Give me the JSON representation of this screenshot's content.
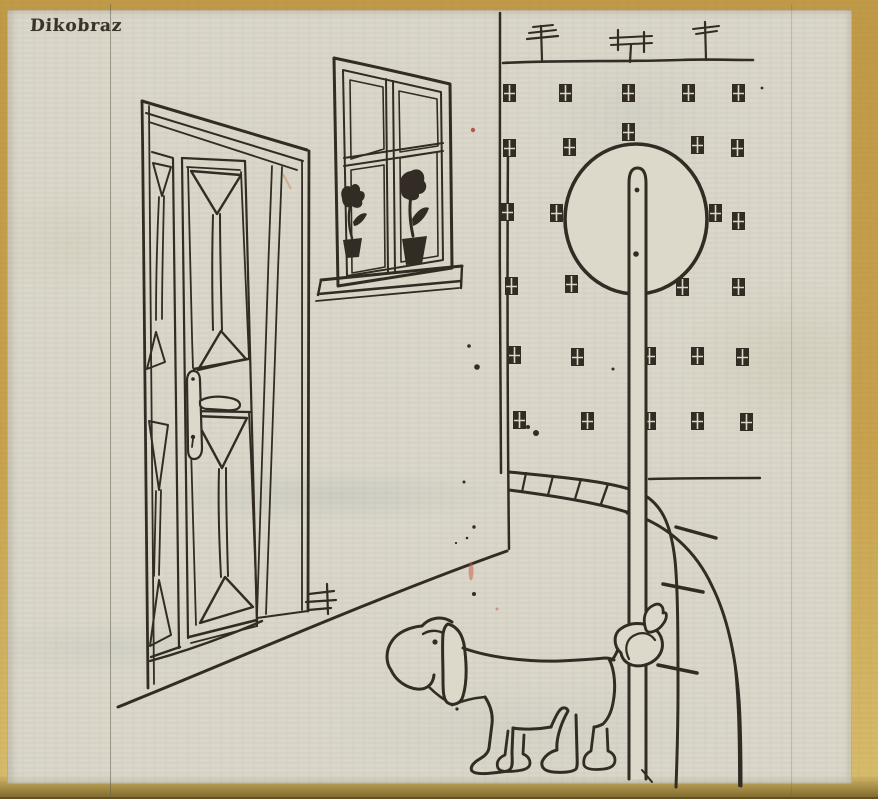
{
  "masthead": {
    "label": "Dikobraz"
  },
  "scene": {
    "description": "Hand-drawn ink cartoon: a long-eared dog stands in a street with its tail tied in a knot around a tall sign pole topped by a large circle. To the left, a house with an open paneled double door (lever handle and keyhole plate) and a four-pane window holding two potted flowers on the sill. Behind, a building facade with a roofline carrying three TV antennas and rows of tiny four-pane windows, a low stone parapet that curves down as an arch of blocks, and scattered ink specks on aged, yellow-bordered newsprint with bleed-through text."
  },
  "objects": [
    "paneled-double-door",
    "door-lever-handle",
    "keyhole-plate",
    "four-pane-window",
    "potted-flower-left",
    "potted-flower-right",
    "window-sill",
    "house-corner",
    "floor-line",
    "hatch-mark",
    "background-facade",
    "roofline",
    "tv-antenna-1",
    "tv-antenna-2",
    "tv-antenna-3",
    "facade-windows",
    "round-sign",
    "sign-pole",
    "pole-bolts",
    "stone-parapet-arch",
    "ground-line",
    "dog",
    "tail-knot",
    "ink-specks",
    "red-specks"
  ],
  "colors": {
    "paper": "#dcd8ca",
    "ink": "#322c24",
    "border": "#c9a24b",
    "red": "#b0402f",
    "masthead": "#3a332a"
  }
}
